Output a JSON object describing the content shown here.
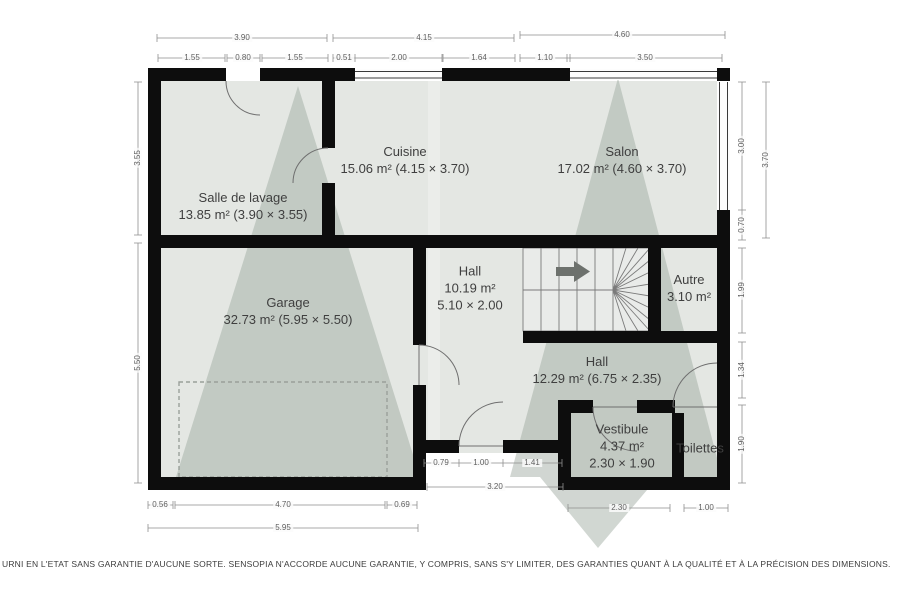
{
  "plan": {
    "rooms": [
      {
        "id": "salle-de-lavage",
        "lines": [
          "Salle de lavage",
          "13.85 m² (3.90 × 3.55)"
        ],
        "x": 243,
        "y": 206
      },
      {
        "id": "cuisine",
        "lines": [
          "Cuisine",
          "15.06 m² (4.15 × 3.70)"
        ],
        "x": 405,
        "y": 160
      },
      {
        "id": "salon",
        "lines": [
          "Salon",
          "17.02 m² (4.60 × 3.70)"
        ],
        "x": 622,
        "y": 160
      },
      {
        "id": "garage",
        "lines": [
          "Garage",
          "32.73 m² (5.95 × 5.50)"
        ],
        "x": 288,
        "y": 311
      },
      {
        "id": "hall",
        "lines": [
          "Hall",
          "10.19 m²",
          "5.10 × 2.00"
        ],
        "x": 470,
        "y": 288
      },
      {
        "id": "autre",
        "lines": [
          "Autre",
          "3.10 m²"
        ],
        "x": 689,
        "y": 288
      },
      {
        "id": "hall-2",
        "lines": [
          "Hall",
          "12.29 m² (6.75 × 2.35)"
        ],
        "x": 597,
        "y": 370
      },
      {
        "id": "vestibule",
        "lines": [
          "Vestibule",
          "4.37 m²",
          "2.30 × 1.90"
        ],
        "x": 622,
        "y": 446
      },
      {
        "id": "toilettes",
        "lines": [
          "Toilettes"
        ],
        "x": 700,
        "y": 448
      }
    ],
    "dimensions": [
      {
        "v": "3.90",
        "x": 242,
        "y": 38,
        "o": "h"
      },
      {
        "v": "4.15",
        "x": 424,
        "y": 38,
        "o": "h"
      },
      {
        "v": "4.60",
        "x": 622,
        "y": 35,
        "o": "h"
      },
      {
        "v": "1.55",
        "x": 192,
        "y": 58,
        "o": "h"
      },
      {
        "v": "0.80",
        "x": 243,
        "y": 58,
        "o": "h"
      },
      {
        "v": "1.55",
        "x": 295,
        "y": 58,
        "o": "h"
      },
      {
        "v": "0.51",
        "x": 344,
        "y": 58,
        "o": "h"
      },
      {
        "v": "2.00",
        "x": 399,
        "y": 58,
        "o": "h"
      },
      {
        "v": "1.64",
        "x": 479,
        "y": 58,
        "o": "h"
      },
      {
        "v": "1.10",
        "x": 545,
        "y": 58,
        "o": "h"
      },
      {
        "v": "3.50",
        "x": 645,
        "y": 58,
        "o": "h"
      },
      {
        "v": "3.55",
        "x": 138,
        "y": 158,
        "o": "v"
      },
      {
        "v": "5.50",
        "x": 138,
        "y": 363,
        "o": "v"
      },
      {
        "v": "3.00",
        "x": 742,
        "y": 146,
        "o": "v"
      },
      {
        "v": "3.70",
        "x": 766,
        "y": 160,
        "o": "v"
      },
      {
        "v": "0.70",
        "x": 742,
        "y": 225,
        "o": "v"
      },
      {
        "v": "1.99",
        "x": 742,
        "y": 290,
        "o": "v"
      },
      {
        "v": "1.34",
        "x": 742,
        "y": 370,
        "o": "v"
      },
      {
        "v": "1.90",
        "x": 742,
        "y": 444,
        "o": "v"
      },
      {
        "v": "0.79",
        "x": 441,
        "y": 463,
        "o": "h"
      },
      {
        "v": "1.00",
        "x": 481,
        "y": 463,
        "o": "h"
      },
      {
        "v": "1.41",
        "x": 532,
        "y": 463,
        "o": "h"
      },
      {
        "v": "3.20",
        "x": 495,
        "y": 487,
        "o": "h"
      },
      {
        "v": "0.56",
        "x": 160,
        "y": 505,
        "o": "h"
      },
      {
        "v": "4.70",
        "x": 283,
        "y": 505,
        "o": "h"
      },
      {
        "v": "0.69",
        "x": 402,
        "y": 505,
        "o": "h"
      },
      {
        "v": "5.95",
        "x": 283,
        "y": 528,
        "o": "h"
      },
      {
        "v": "2.30",
        "x": 619,
        "y": 508,
        "o": "h"
      },
      {
        "v": "1.00",
        "x": 706,
        "y": 508,
        "o": "h"
      }
    ],
    "stairs": {
      "direction": "right"
    },
    "disclaimer": "URNI EN L'ETAT SANS GARANTIE D'AUCUNE SORTE. SENSOPIA N'ACCORDE AUCUNE GARANTIE, Y COMPRIS, SANS S'Y LIMITER, DES GARANTIES QUANT À LA QUALITÉ ET À LA PRÉCISION DES DIMENSIONS."
  },
  "colors": {
    "wall": "#0d0d0d",
    "floor": "#e4e7e3",
    "watermark": "#9aa69c",
    "dim_line": "#8f8f8f",
    "dim_text": "#5f5f5f",
    "room_text": "#3f3f3f",
    "stair_line": "#7a7a7a",
    "arrow": "#6d716d",
    "window_line": "#3a3a3a",
    "door_line": "#6f6f6f",
    "dashed": "#9aa09a"
  }
}
